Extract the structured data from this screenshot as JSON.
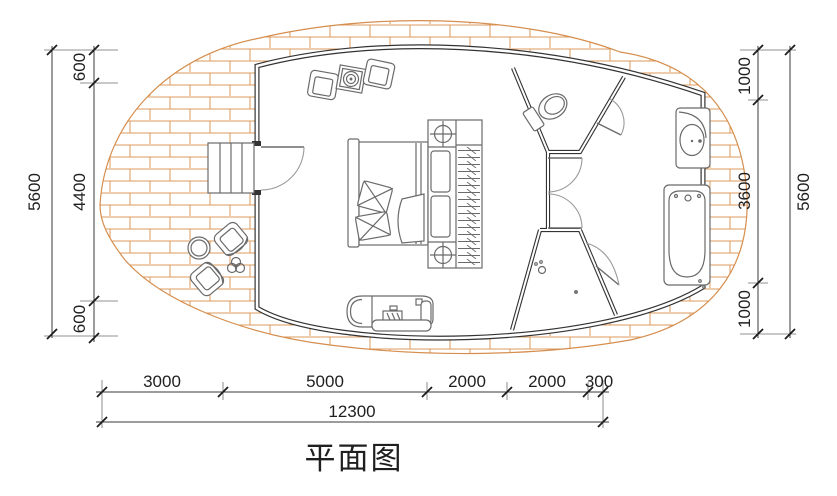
{
  "title": {
    "text": "平面图"
  },
  "dims": {
    "left": {
      "total": "5600",
      "segments": [
        "600",
        "4400",
        "600"
      ]
    },
    "right": {
      "total": "5600",
      "segments": [
        "1000",
        "3600",
        "1000"
      ]
    },
    "bottom": {
      "total": "12300",
      "segments": [
        "3000",
        "5000",
        "2000",
        "2000",
        "300"
      ]
    }
  },
  "colors": {
    "deck_brick": "#dc9a5e",
    "deck_edge": "#d58e4e",
    "wall": "#333333",
    "furniture": "#6a6a6a",
    "dim_text": "#1f1f1f"
  }
}
